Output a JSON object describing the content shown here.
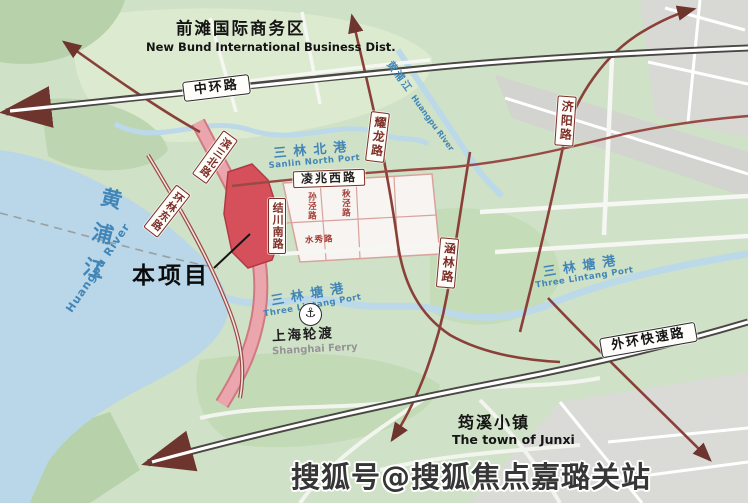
{
  "regions": {
    "new_bund_zh": "前滩国际商务区",
    "new_bund_en": "New Bund International Business Dist.",
    "junxi_zh": "筠溪小镇",
    "junxi_en": "The town of Junxi"
  },
  "roads": {
    "zhonghuan": "中环路",
    "waihuan": "外环快速路",
    "lingzhao_xi": "凌兆西路",
    "yaolong": "耀龙路",
    "jiyang": "济阳路",
    "hanlin": "涵林路",
    "jiechuan_nan": "结川南路",
    "binsan_bei": "滨三北路",
    "huanlin_dong": "环林东路",
    "sunjing": "孙泾路",
    "qiujing": "秋泾路",
    "shuixiu": "水秀路"
  },
  "waters": {
    "huangpu_zh": "黄浦江",
    "huangpu_en": "Huangpu River",
    "river_ne_zh": "黄浦江",
    "river_ne_en": "Huangpu River",
    "sanlin_bei_zh": "三林北港",
    "sanlin_bei_en": "Sanlin North Port",
    "sanlin_tang_zh": "三林塘港",
    "sanlin_tang_en": "Three Lintang Port",
    "sanlin_tang_east_zh": "三林塘港",
    "sanlin_tang_east_en": "Three Lintang Port"
  },
  "pois": {
    "project": "本项目",
    "ferry_zh": "上海轮渡",
    "ferry_en": "Shanghai Ferry",
    "anchor_icon": "⚓"
  },
  "watermark": "搜狐号@搜狐焦点嘉璐关站",
  "colors": {
    "project_red": "#d5505a",
    "road_red": "#8a4038",
    "pink_road": "#eba6ad",
    "water_blue": "#b9d7e8",
    "label_blue": "#4286b8",
    "highway_dark": "#4a4744"
  }
}
